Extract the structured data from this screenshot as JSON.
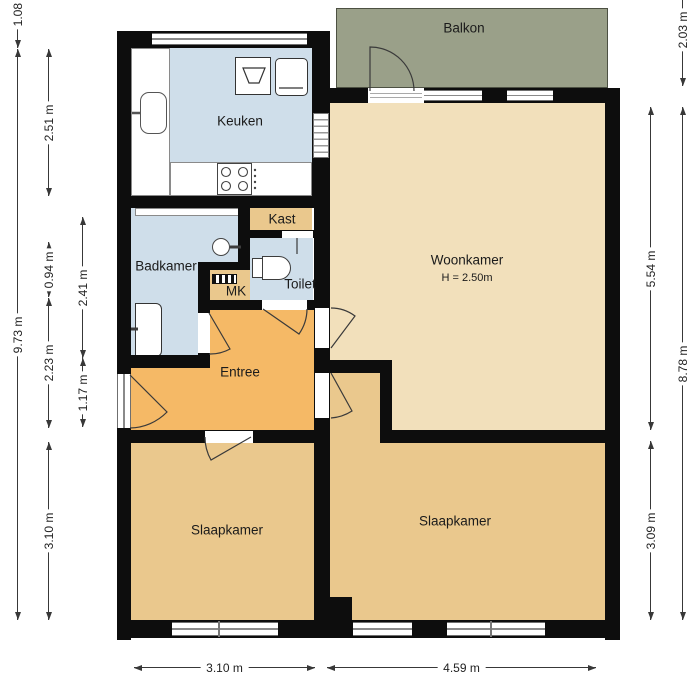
{
  "plan": {
    "rooms": {
      "balkon": "Balkon",
      "keuken": "Keuken",
      "woonkamer": "Woonkamer",
      "woonkamer_height": "H = 2.50m",
      "kast": "Kast",
      "badkamer": "Badkamer",
      "toilet": "Toilet",
      "mk": "MK",
      "entree": "Entree",
      "slaapkamer_left": "Slaapkamer",
      "slaapkamer_right": "Slaapkamer"
    },
    "dimensions": {
      "left_outer_top": "1.08 m",
      "left_outer_total": "9.73 m",
      "left_keuken": "2.51 m",
      "left_mk": "0.94 m",
      "left_entree": "2.23 m",
      "left_slaapkamer": "3.10 m",
      "left_badkamer": "2.41 m",
      "left_hal": "1.17 m",
      "right_balkon": "2.03 m",
      "right_total": "8.78 m",
      "right_woonkamer": "5.54 m",
      "right_slaapkamer": "3.09 m",
      "bottom_left": "3.10 m",
      "bottom_right": "4.59 m"
    },
    "colors": {
      "wall": "#0d0d0d",
      "wet_room": "#cfdeea",
      "living": "#f2e0bb",
      "bedroom": "#eac88d",
      "hall": "#f5b966",
      "balcony": "#9aa089"
    }
  }
}
